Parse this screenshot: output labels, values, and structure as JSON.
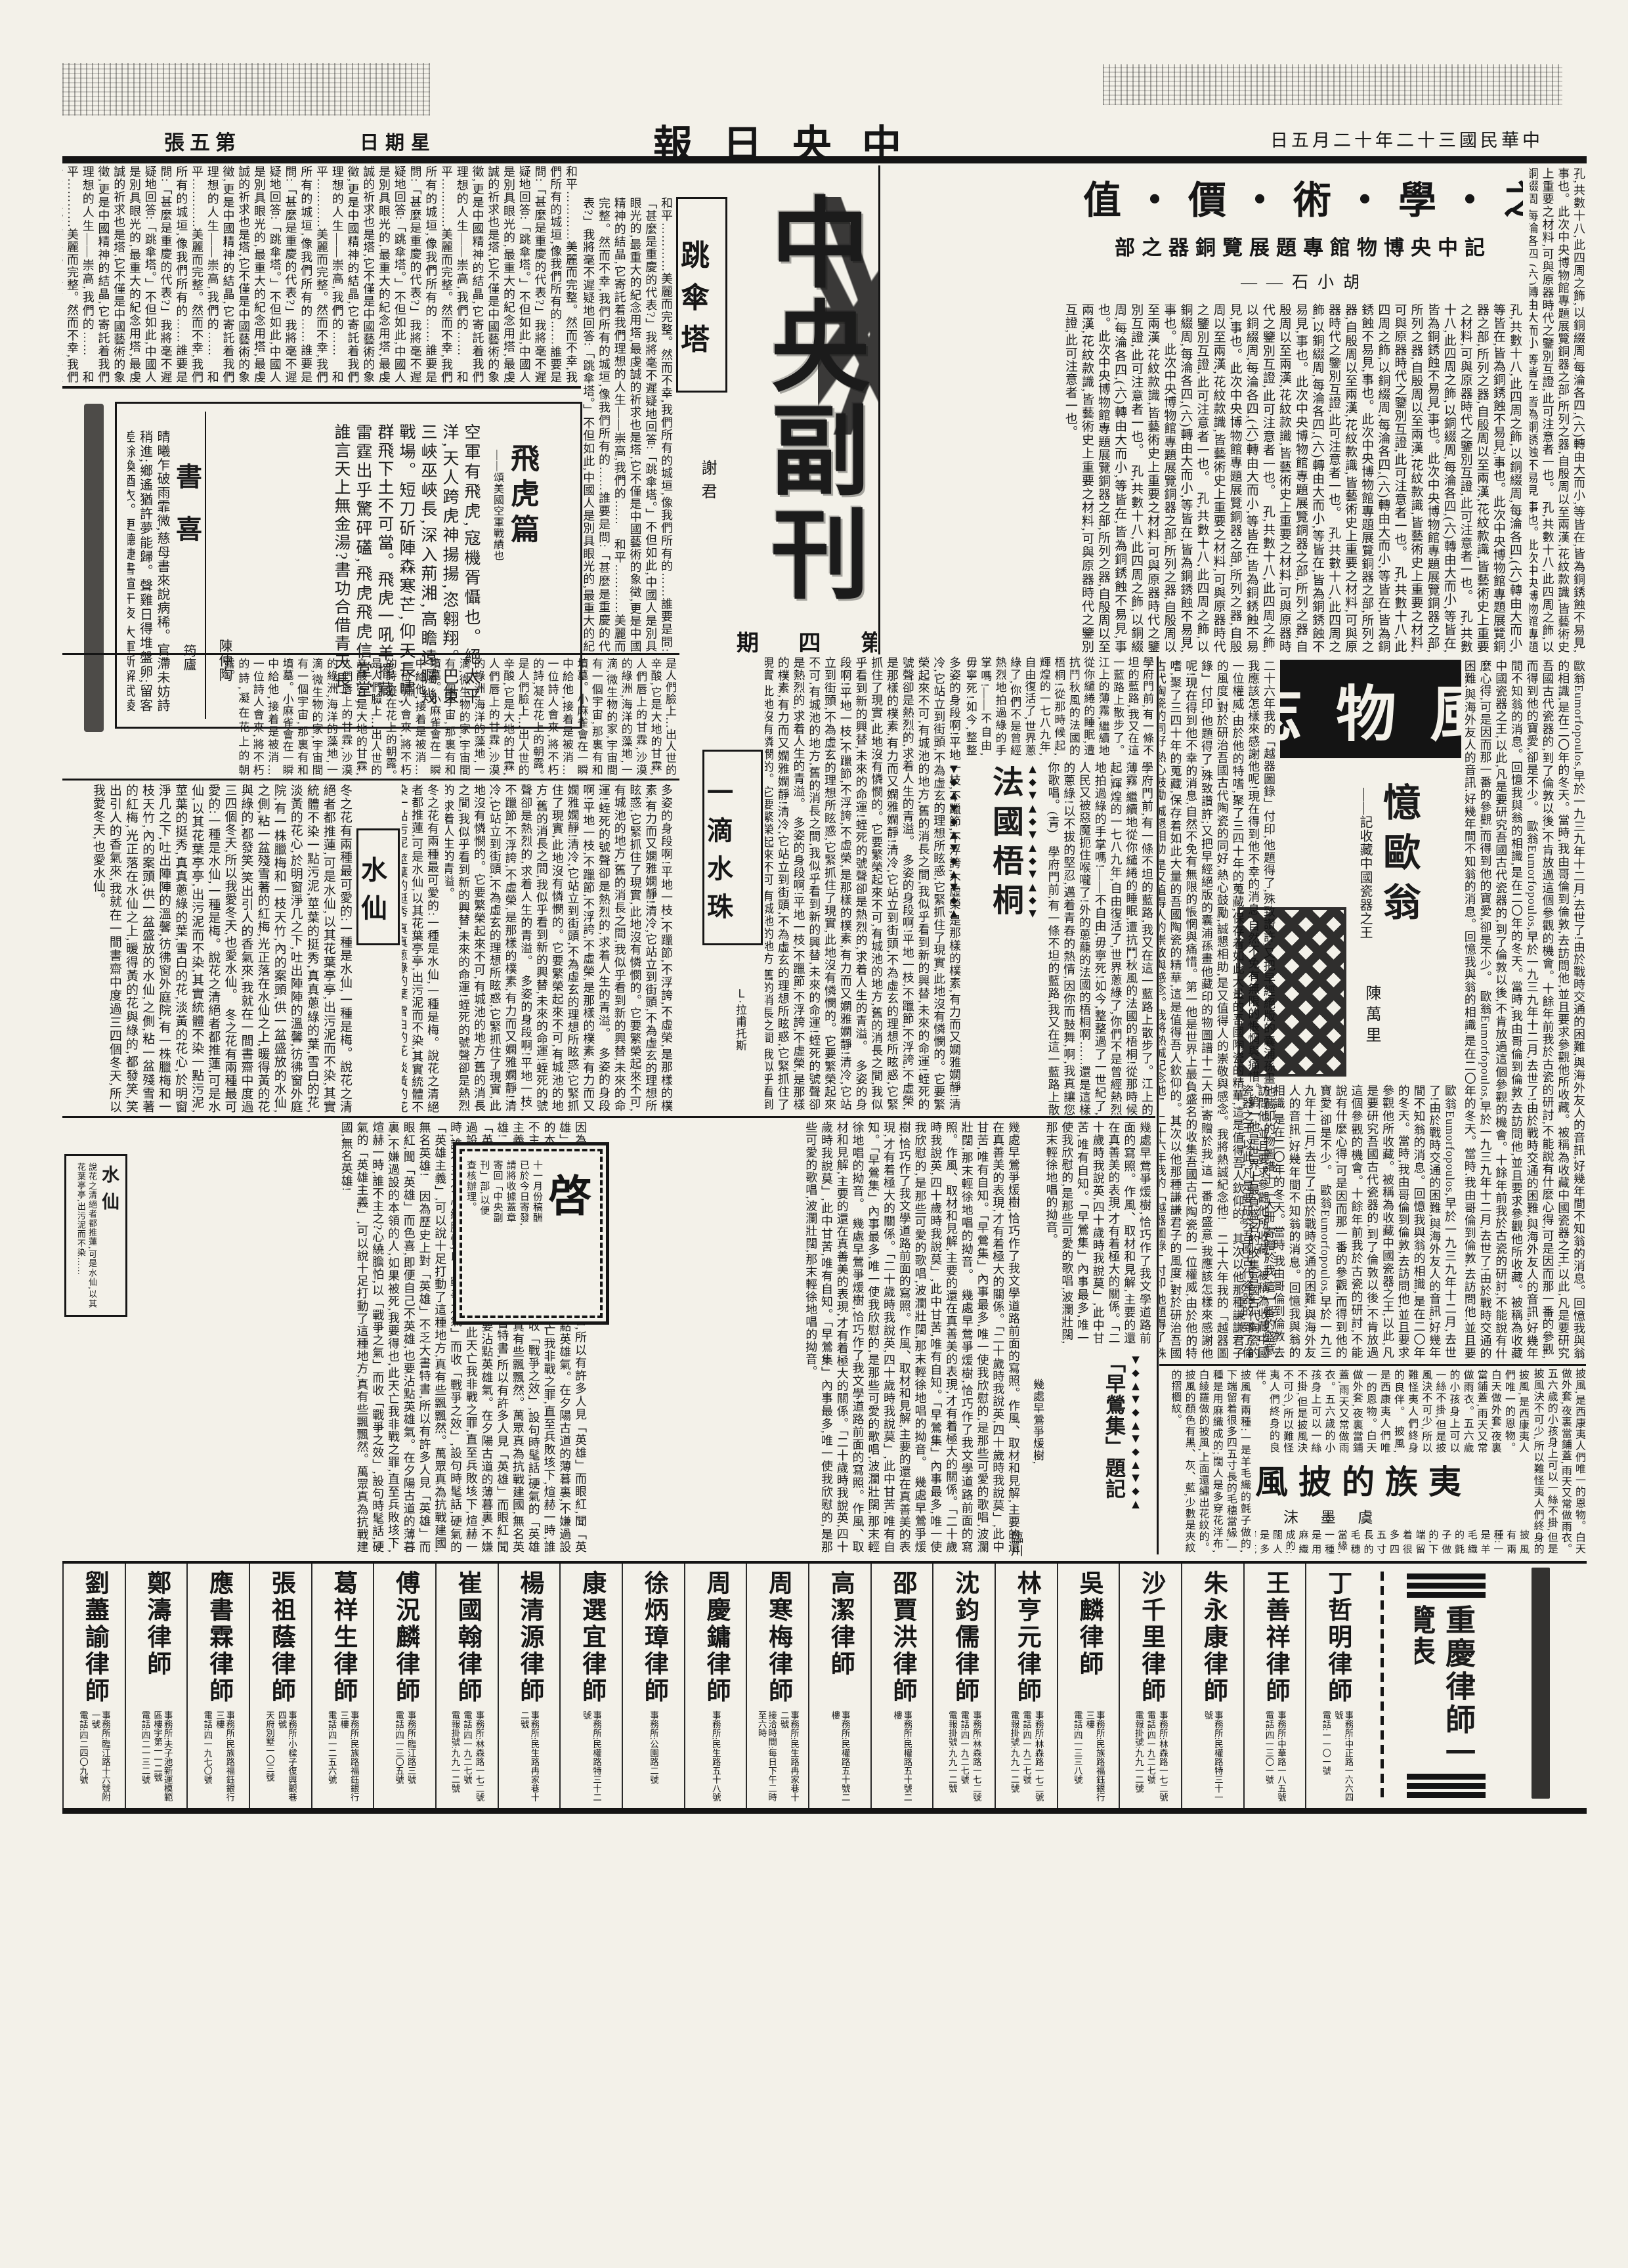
{
  "page": {
    "edition_display": "張五第",
    "weekday_display": "日期星",
    "date_display": "日五月二十年二十三國民華中",
    "masthead_display": "報日央中",
    "ink": "#161616",
    "paper": "#f3f1e9"
  },
  "bronze_article": {
    "headline_display": "值・價・術・學・之・器・銅",
    "subtitle_display": "部之器銅覽展題專館物博央中記",
    "author_display": "——石小胡",
    "body": "孔,共數十八,此四周之飾,以銅綴周,每淪各四,(六)轉由大而小,等皆在,皆為銅銹蝕不易見,事也。此次中央博物館專題展覽銅器之部,所列之器,自殷周以至兩漢,花紋款識,皆藝術史上重要之材料,可與原器時代之鑒別互證,此可注意者一也。"
  },
  "supplement": {
    "calligraphy_title": "中央副刊",
    "issue_display": "期 四 第"
  },
  "parachute_article": {
    "title": "跳傘塔",
    "author": "謝君",
    "body": "和平…………美麗而完整。然而不幸,我們所有的城垣,像我們所有的……誰要是問:「甚麼是重慶的代表?」我將毫不遲疑地回答:「跳傘塔。」不但如此,中國人是別具眼光的,最重大的紀念用塔,最虔誠的祈求也是塔,它不僅是中國藝術的象徵,更是中國精神的結晶,它寄託着我們理想的人生——崇高,我們的……"
  },
  "flying_tiger_poem": {
    "title": "飛虎篇",
    "dedication": "——頌美國空軍戰績也",
    "author": "陳仲陶",
    "body": "空軍有飛虎,寇機胥懾也。絕太平洋,天人跨虎神揚揚,恣翱翔。巴東三峽巫峽長,深入荊湘,高瞻遠矚幾戰場。短刀斫陣森寒芒,仰天長嘯,群飛下土不可當。飛虎一吼羊擺藏,雷霆出乎驚砰礚,飛虎飛虎信堂堂,誰言天上無金湯?書功合借青天長!"
  },
  "book_joy_poem": {
    "title": "書喜",
    "author": "筠廬",
    "body": "晴曦乍破雨霏微,慈母書來說病稀。官滯未妨詩稍進;鄉遙猶許夢能歸。聲雞日得堆盤卵;留客差餘換酒衣。更聽捷書喧午夜,大軍新解武陵圍。"
  },
  "fengwu_banner": {
    "title_display": "志 物 風"
  },
  "remember_ou": {
    "title": "憶歐翁",
    "subtitle": "——記收藏中國瓷器之王",
    "author": "陳萬里",
    "body": "歐翁Eumorfopoulos,早於一九三九年十二月,去世了!由於戰時交通的困難,與海外友人的音訊,好幾年間不知翁的消息。回憶我與翁的相識,是在二〇年的冬天。當時,我由哥倫到倫敦,去訪問他,並且要求參觀他所收藏。被稱為收藏中國瓷器之王,以此,凡是要研究吾國古代瓷器的,到了倫敦以後,不肯放過這個參觀的機會。十餘年前我於古瓷的研討,不能說有什麼心得,可是因而那一番的參觀,而得到他的寶愛,卻是不少。",
    "body2": "二十六年我的「越器圖錄」付印,他題得了,殊致讚許;又把早經絕版的囊浦孫畫他藏印的物圖譜十二大冊,寄贈於我,這一番的盛意,我應該怎樣來感謝他呢!現在得到他不幸的消息,自然不免有無限的悵惘與痛惜。第一他是世界上最負盛名的收集吾國古代陶瓷的一位權威,由於他的特嗜,聚了三四十年的蒐藏,保存着如此大量的吾國陶瓷的精華,這是值得吾人欽仰的。其次以他那種謙謙君子的風度,對於研治吾國古代陶瓷的同好,熱心鼓勵,誠懇相助,是又值得人的崇敬與感念。我將熱誠紀念他!"
  },
  "water_drop": {
    "title": "一滴水珠",
    "author": "Ｌ·拉甫托斯",
    "intro": "是人們臉上…出人世的辛酸,它是大地的甘霖,人們唇上的甘霖,沙漠的綠洲,海洋的藻地,一滴,微生物的家,宇宙間有一個宇宙,那裏有和墳墓。小麻雀會在一瞬中給他,接着是被消…一位詩人會來,將不朽的詩,凝在花上的朝露。",
    "body": "多姿的身段啊!平地一枝,不躐節,不浮誇,不虛榮,是那樣的樸素,有力而又嫻雅嫻靜!清冷,它站立到街頭,不為虛玄的理想所眩惑,它緊抓住了現實,此地沒有憐憫的。它要繁榮起來不可,有城池的地方,舊的消長之間,我似乎看到新的興替,未來的命運!蛭死的號聲卻是熱烈的,求着人生的青溢。"
  },
  "narcissus": {
    "title": "水仙",
    "body": "冬之花有兩種最可愛的:一種是水仙,一種是梅。說花之清絕者都推蓮,可是水仙,以其花葉亭亭,出污泥而不染,其實統體不染一點污泥,莖葉的挺秀,真真蔥綠的葉,雪白的花,淡黃的花心,於明窗淨几之下,吐出陣陣的溫馨,彷彿窗外庭院,有一株臘梅和一枝天竹,內的案頭,供一盆盛放的水仙,之側,粘一盆殘雪著的紅梅,光正落在水仙之上,暖得黃的花與綠的,都發笑,笑出引人的香氣來,我就在一間書齋中度過三四個冬天,所以我愛冬天,也愛水仙。"
  },
  "narcissus_small_box": {
    "title": "水仙",
    "body": "說花之清絕者都推蓮,可是水仙,以其花葉亭亭,出污泥而不染……"
  },
  "french_plane": {
    "title": "法國梧桐",
    "body": "學府門前,有一條不坦的藍路,我又在這一藍路上散步了。江上的薄霧,繼續地從你繾綣的睡眠,遭抗鬥秋風的法國的梧桐!從那時候起,輝煌的一七八九年,自由復活了,世界蔥綠了,你們不是曾經熱烈地拍過綠的手掌嗎!——不自由,毋寧死!如今,整整過了一世紀了,人民又被惡魔扼住喉嚨了!外的蔥蘢的法國的梧桐啊……還是這樣的蔥綠!以不拔的堅忍,邁着青春的熱情,因你而鼓舞,啊,我真讓您你歌唱。(青)"
  },
  "notice_box": {
    "title": "啓",
    "lines": [
      "十一月份稿酬",
      "已於今日寄發,",
      "請將收據蓋章",
      "寄回「中央副",
      "刊」部,以便",
      "查核辦理。"
    ]
  },
  "cloak_article": {
    "headline_display": "風披的族夷",
    "author_display": "沫 墨 虞",
    "body": "披風,是西康夷人們唯一的恩物。白天做外套,夜裏當鋪蓋,雨天又常做雨衣。五六歲的小孩身上可以一絲不掛,但是披風決不可少,所以難怪夷人們終身的良伴。",
    "body2": "披風有兩種:一是羊毛織的氈子做的,下端留着很多四五寸長的毛穗當緣,一種是用麻織成的;闊人是多穿花洋布,白綾羅做的披風,上面還繡出花紋的。披風的顏色有黑、灰、藍,少數是夾紋的摺櫚紋。"
  },
  "early_oriole": {
    "title": "「早鶯集」題記",
    "first_line": "幾處早鶯爭煖樹,",
    "author": "臨川",
    "body": "幾處早鶯爭煖樹,恰巧作了我文學道路前面的寫照。作風、取材和見解,主要的還在真善美的表現,才有着極大的關係。「二十歲時我說英,四十歲時我說莫」,此中甘苦,唯有自知。「早鶯集」內事最多,唯一使我欣慰的,是那些可愛的歌唱,波瀾壯闊,那末輕徐地唱的拗音。",
    "body2": "因為歷史上對「英雄」不乏大書特書,所以有許多人見「英雄」而眼紅,聞「英雄」而色喜,即便自己不英雄,也要沾點英雄氣。在夕陽古道的薄暮裏,不嫌過設的本領的人,如果被死,我要得也,此天亡我非戰之罪,直至兵敗垓下,煊赫一時,誰不主之?心繞膽怕,以「戰爭之氣」而收「戰爭之效」,設句時髦話,硬氣的「英雄主義」,可以說十足打動了這種地方,真有些飄飄然。萬眾真為抗戰建國,無名英雄!"
  },
  "directory": {
    "title": "重慶律師一覽表",
    "entries": [
      {
        "name": "丁哲明律師",
        "lines": [
          "事務所:中正路一六六四號",
          "電話:一一〇一號"
        ]
      },
      {
        "name": "王善祥律師",
        "lines": [
          "事務所:中華路一八五號",
          "電話:四一三〇一號"
        ]
      },
      {
        "name": "朱永康律師",
        "lines": [
          "事務所:民權路特三十一號"
        ]
      },
      {
        "name": "沙千里律師",
        "lines": [
          "事務所:林森路一七二號",
          "電話:四一九二七號",
          "電報掛號:九九一二號"
        ]
      },
      {
        "name": "吳麟律師",
        "lines": [
          "事務所:民族路福鈺銀行三樓",
          "電話:四一三三八號"
        ]
      },
      {
        "name": "林亨元律師",
        "lines": [
          "事務所:林森路一七二號",
          "電話:四一九二七號",
          "電報掛號:九九一二號"
        ]
      },
      {
        "name": "沈鈞儒律師",
        "lines": [
          "事務所:林森路一七二號",
          "電話:四一九二七號",
          "電報掛號:九九一二號"
        ]
      },
      {
        "name": "邵賈洪律師",
        "lines": [
          "事務所:民權路五十號二樓"
        ]
      },
      {
        "name": "高潔律師",
        "lines": [
          "事務所:民權路五十號二樓"
        ]
      },
      {
        "name": "周寒梅律師",
        "lines": [
          "事務所:民生路冉家巷十二號",
          "接洽時間:每日下午二時至六時"
        ]
      },
      {
        "name": "周慶鏞律師",
        "lines": [
          "事務所:民生路五十八號"
        ]
      },
      {
        "name": "徐炳璋律師",
        "lines": [
          "事務所:公園路二號"
        ]
      },
      {
        "name": "康選宜律師",
        "lines": [
          "事務所:民權路特三十二號"
        ]
      },
      {
        "name": "楊清源律師",
        "lines": [
          "事務所:民生路冉家巷十二號"
        ]
      },
      {
        "name": "崔國翰律師",
        "lines": [
          "事務所:林森路一七二號",
          "電話:四一九二七號",
          "電報掛號:九九一二號"
        ]
      },
      {
        "name": "傅況麟律師",
        "lines": [
          "事務所:臨江路三號",
          "電話:四一三〇五號"
        ]
      },
      {
        "name": "葛祥生律師",
        "lines": [
          "事務所:民族路福鈺銀行三樓",
          "電話:四一二五六號"
        ]
      },
      {
        "name": "張祖蔭律師",
        "lines": [
          "事務所:小樑子復興觀巷四號",
          "天府別墅一〇三號"
        ]
      },
      {
        "name": "應書霖律師",
        "lines": [
          "事務所:民族路福鈺銀行三樓",
          "電話:四一九七〇號"
        ]
      },
      {
        "name": "鄭濤律師",
        "lines": [
          "事務所:夫子池新運模範區樓宇第一一二號",
          "電話:四二一三二號"
        ]
      },
      {
        "name": "劉藎諭律師",
        "lines": [
          "事務所:臨江路十六號附一號",
          "電話:四二四〇九號"
        ]
      }
    ]
  }
}
